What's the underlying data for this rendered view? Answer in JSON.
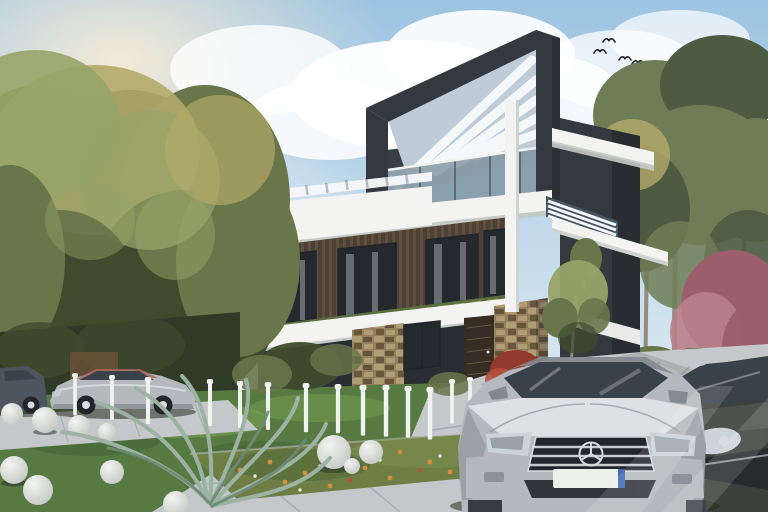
{
  "palette": {
    "sky_top": "#9cc4e2",
    "sky_bottom": "#eef4f6",
    "sun_glow": "#f6ecd6",
    "cloud": "#ffffff",
    "bird": "#1f2125",
    "tree_dark": "#3e4c2d",
    "tree_mid": "#68764a",
    "tree_light": "#97a468",
    "tree_yellow": "#b4aa6a",
    "pine_dark": "#4d5b41",
    "pine_mid": "#6e7d56",
    "trunk": "#90887a",
    "purple_tree": "#9a5e6d",
    "purple_light": "#b97f8a",
    "hedge": "#2f3b26",
    "fence_brown": "#6d5138",
    "frame_dark": "#34383f",
    "frame_darker": "#212428",
    "slab_white": "#f3f4f2",
    "slab_shadow": "#c6cac7",
    "ceiling_blue": "#bfccd8",
    "pergola_slat": "#f5f8fa",
    "glass": "#7d929e",
    "glass_dark": "#46565f",
    "wood_wall": "#4d4136",
    "wood_slat": "#6e5c4b",
    "window_dark": "#24292d",
    "curtain": "#cdd2d4",
    "planter_green": "#5a6f3f",
    "planter_light": "#83975a",
    "stone_base": "#957f5c",
    "stone_light": "#b5a277",
    "stone_dark": "#5e5037",
    "door_brown": "#382d24",
    "red_bush": "#93392e",
    "red_bush_light": "#b5503d",
    "grass": "#567a42",
    "grass_light": "#78a054",
    "grass_dark": "#3c5a2f",
    "flower_bed": "#6e7e44",
    "flower_orange": "#d3903e",
    "flower_white": "#eae6d3",
    "paver": "#c4c8cb",
    "paver_dark": "#8d959a",
    "driveway_dark": "#6c747a",
    "sphere_hi": "#f4f5f2",
    "sphere_lo": "#b9bdb8",
    "bollard": "#f1f3f0",
    "palm": "#9cb3a3",
    "palm_dark": "#6e8a75",
    "car_silver": "#b5b9bd",
    "car_silver_dark": "#82888d",
    "car_silver_light": "#dde1e4",
    "car_glass": "#39414a",
    "grille": "#22252a",
    "chrome": "#d8dcdf",
    "headlight": "#cdd4d9",
    "plate": "#edefeb",
    "plate_blue": "#2b5cab",
    "car_dark": "#3b413c",
    "car_dark_light": "#5d655f",
    "car_navy": "#4d565e",
    "coupe_red": "#a96a60",
    "shadow": "#262c21",
    "watermark": "#ffffff"
  }
}
